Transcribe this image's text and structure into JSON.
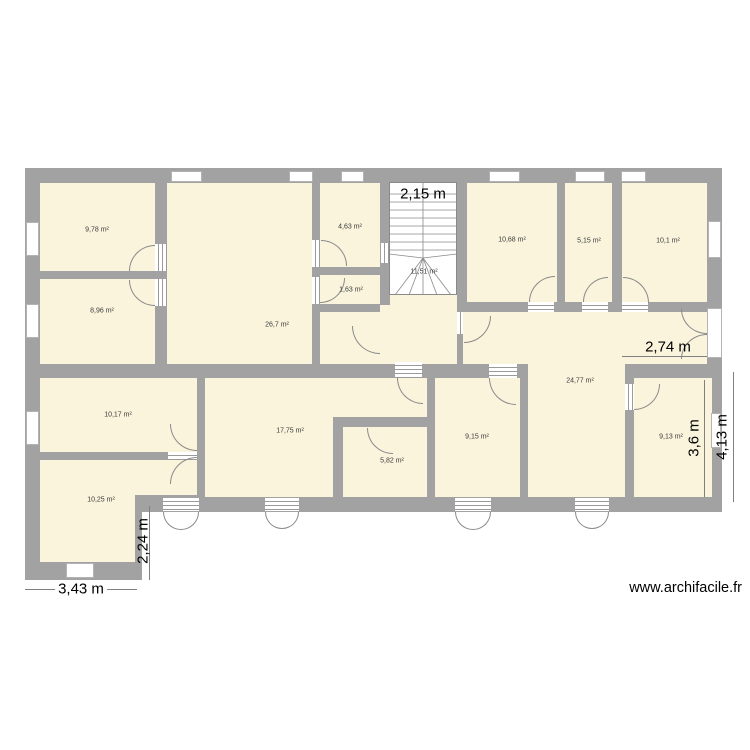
{
  "title": "floor-plan",
  "watermark": "www.archifacile.fr",
  "colors": {
    "wall": "#a2a2a2",
    "floor": "#faf4dd",
    "background": "#ffffff",
    "door_arc": "#8a8a8a"
  },
  "rooms": {
    "tl1": "9,78 m²",
    "tl2": "8,96 m²",
    "living": "26,7 m²",
    "sm1": "4,63 m²",
    "sm2": "1,63 m²",
    "stair": "11,51 m²",
    "t3": "10,68 m²",
    "t4": "5,15 m²",
    "t5": "10,1 m²",
    "hall": "24,77 m²",
    "bl1": "10,17 m²",
    "bl2": "10,25 m²",
    "bm1": "17,75 m²",
    "bm2": "5,82 m²",
    "bc": "9,15 m²",
    "br": "9,13 m²"
  },
  "dims": {
    "stair_w": "2,15 m",
    "hall_w": "2,74 m",
    "br_h": "3,6 m",
    "right_h": "4,13 m",
    "bl_h": "2,24 m",
    "bl_w": "3,43 m"
  }
}
